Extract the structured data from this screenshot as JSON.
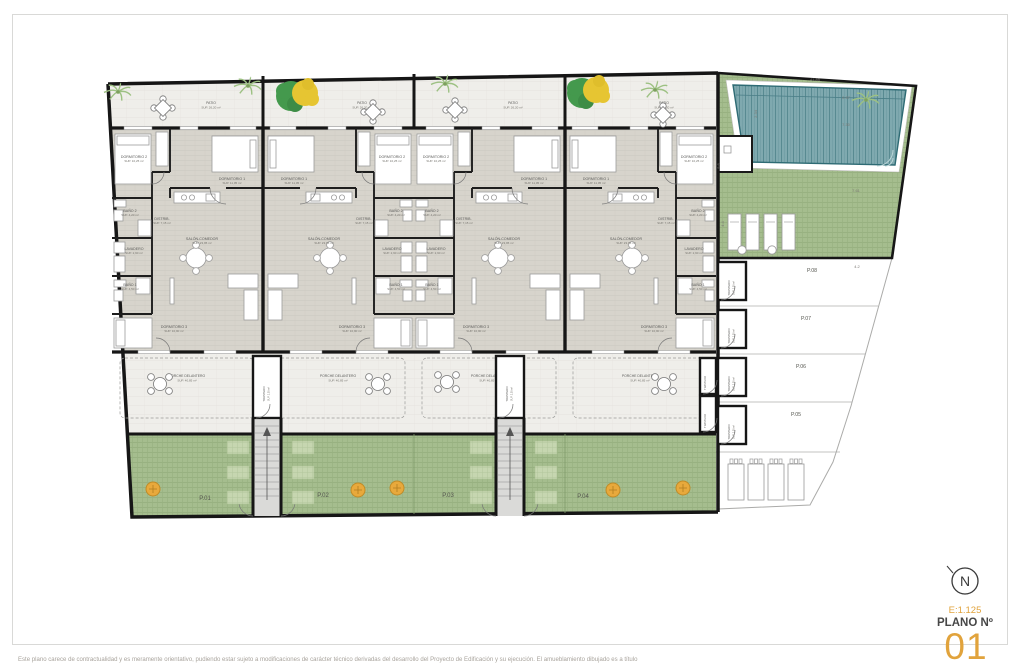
{
  "title_block": {
    "north_letter": "N",
    "scale": "E:1.125",
    "plan_label": "PLANO Nº",
    "plan_number": "01"
  },
  "disclaimer": "Este plano carece de contractualidad y es meramente orientativo, pudiendo estar sujeto a modificaciones de carácter técnico derivadas del desarrollo del Proyecto de Edificación y su ejecución. El amueblamiento dibujado es a título",
  "colors": {
    "accent_orange": "#E1A33C",
    "wall_black": "#1A1A1A",
    "lawn_green": "#A5BD8E",
    "pool_teal": "#7FA9AF",
    "floor_gray": "#D7D4CC"
  },
  "plan": {
    "rooms": [
      {
        "name": "DORMITORIO 2",
        "sup": "SUP. 10,25 m²",
        "x": 22,
        "y": 30
      },
      {
        "name": "DORMITORIO 1",
        "sup": "SUP. 11,05 m²",
        "x": 120,
        "y": 52
      },
      {
        "name": "BAÑO 2",
        "sup": "SUP. 4,20 m²",
        "x": 18,
        "y": 84
      },
      {
        "name": "DISTRIB.",
        "sup": "SUP. 7,15 m²",
        "x": 50,
        "y": 92
      },
      {
        "name": "LAVADERO",
        "sup": "SUP. 2,90 m²",
        "x": 22,
        "y": 122
      },
      {
        "name": "BAÑO 1",
        "sup": "SUP. 4,50 m²",
        "x": 18,
        "y": 158
      },
      {
        "name": "SALÓN-COMEDOR",
        "sup": "SUP. 23,95 m²",
        "x": 90,
        "y": 112
      },
      {
        "name": "DORMITORIO 3",
        "sup": "SUP. 10,90 m²",
        "x": 62,
        "y": 200
      }
    ],
    "patio_label": {
      "name": "PATIO",
      "sup": "SUP. 26,20 m²"
    },
    "porch_label": {
      "name": "PORCHE DELANTERO",
      "sup": "SUP. 40,85 m²"
    },
    "storage_label": "TRASTERO",
    "storage_sup": "SUP. 2,05 m²",
    "front_plots": [
      "P.01",
      "P.02",
      "P.03",
      "P.04"
    ],
    "side_plots": [
      "P.08",
      "P.07",
      "P.06",
      "P.05"
    ],
    "dimensions": [
      {
        "t": "41.85",
        "x": 815,
        "y": 81,
        "r": 0
      },
      {
        "t": "0.97",
        "x": 846,
        "y": 99,
        "r": 0
      },
      {
        "t": "7.30",
        "x": 846,
        "y": 126,
        "r": 0
      },
      {
        "t": "2.34",
        "x": 757,
        "y": 114,
        "r": -90
      },
      {
        "t": "9.6",
        "x": 720,
        "y": 166,
        "r": -90
      },
      {
        "t": "7.61",
        "x": 856,
        "y": 192,
        "r": 0
      },
      {
        "t": "4.4",
        "x": 724,
        "y": 224,
        "r": -90
      },
      {
        "t": "4.2",
        "x": 857,
        "y": 268,
        "r": 0
      }
    ]
  }
}
